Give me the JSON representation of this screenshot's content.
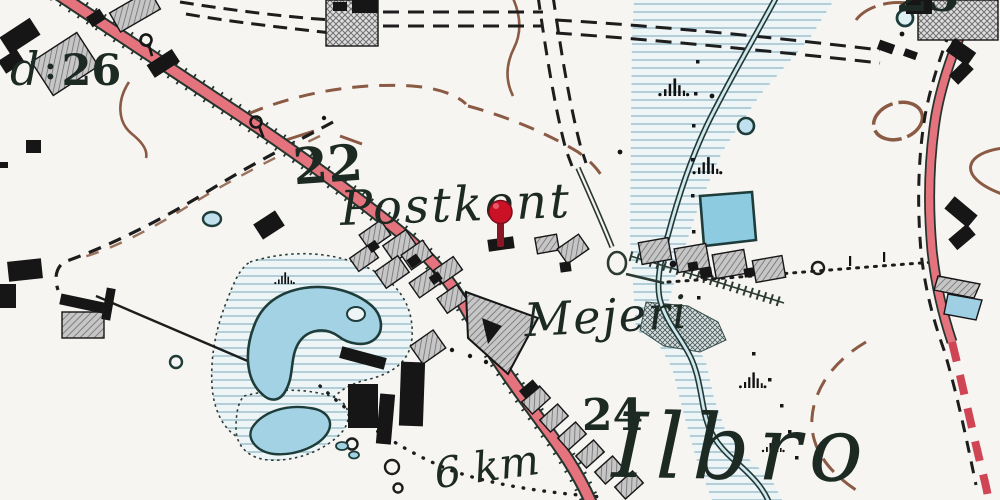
{
  "map": {
    "kind": "historical-topographic-map",
    "labels": {
      "postkontor": "Postkont",
      "mejeri": "Mejeri",
      "ilbro": "Ilbro",
      "distance": "6 km",
      "farm_fragment": "d",
      "separator": ":",
      "elevation_26": "26",
      "elevation_22": "22",
      "elevation_24": "24",
      "elevation_25": "25"
    },
    "marker": {
      "type": "location-pin",
      "color": "#c81828"
    },
    "colors": {
      "background": "#f7f5f1",
      "road_fill": "#e4737e",
      "road_casing": "#25352e",
      "water_fill": "#9fcfe2",
      "meadow_line": "#93b9c6",
      "contour_brown": "#8a5a44",
      "building_black": "#161616",
      "label_ink": "#1d2a24"
    }
  }
}
